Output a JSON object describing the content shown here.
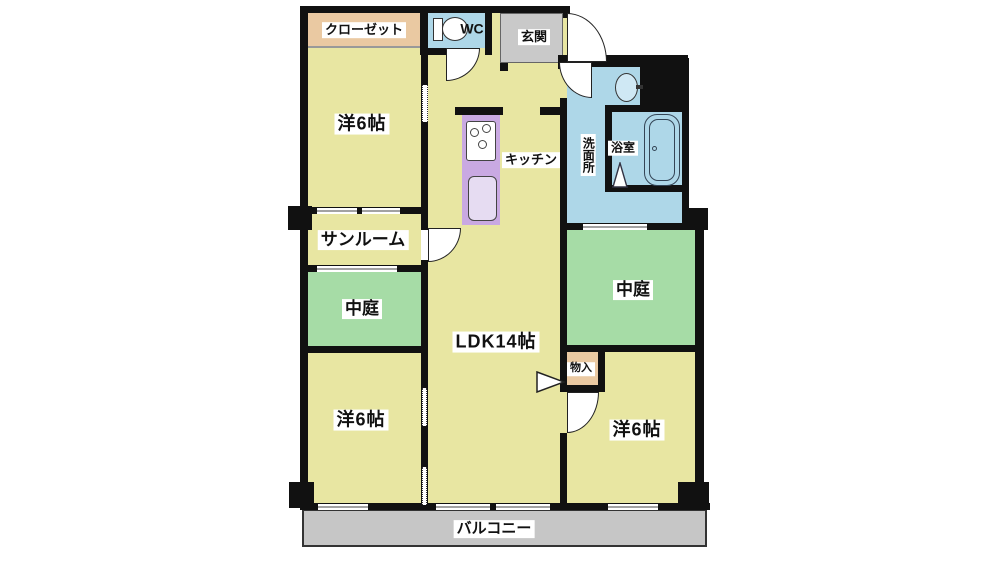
{
  "title": "apartment-floor-plan",
  "rooms": {
    "closet": {
      "label": "クローゼット"
    },
    "wc": {
      "label": "WC"
    },
    "entrance": {
      "label": "玄関"
    },
    "bedroom_top_left": {
      "label": "洋6帖"
    },
    "kitchen": {
      "label": "キッチン"
    },
    "washroom": {
      "label": "洗面所"
    },
    "bathroom": {
      "label": "浴室"
    },
    "sunroom": {
      "label": "サンルーム"
    },
    "courtyard_left": {
      "label": "中庭"
    },
    "ldk": {
      "label": "LDK14帖"
    },
    "courtyard_right": {
      "label": "中庭"
    },
    "storage": {
      "label": "物入"
    },
    "bedroom_bottom_left": {
      "label": "洋6帖"
    },
    "bedroom_bottom_right": {
      "label": "洋6帖"
    },
    "balcony": {
      "label": "バルコニー"
    }
  },
  "colors": {
    "room_yellow": "#e8e6a2",
    "courtyard_green": "#a6dca6",
    "water_blue": "#aed7e8",
    "closet_tan": "#eac9a2",
    "kitchen_purple": "#c9a9e2",
    "entrance_gray": "#c9c9c9",
    "balcony_gray": "#c6c6c6",
    "wall_black": "#111111"
  }
}
